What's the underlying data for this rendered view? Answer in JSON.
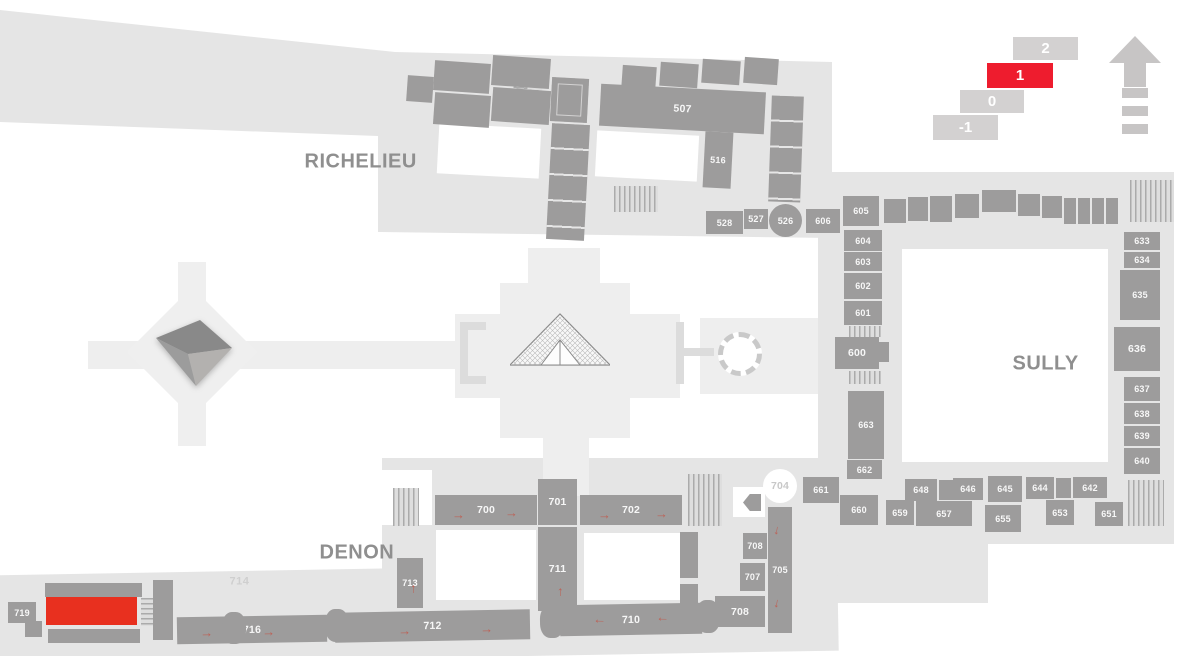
{
  "colors": {
    "building": "#e5e5e5",
    "plaza": "#eeeeee",
    "room": "#9d9c9c",
    "room_text": "#ffffff",
    "selected_room": "#e8301f",
    "floor_active": "#ee1c2e",
    "floor_inactive": "#d3d1d1",
    "wing_label": "#8f8f8f",
    "arrow": "#c2584b"
  },
  "glyphs": {
    "arrow": "→"
  },
  "floor_selector": {
    "floors": [
      {
        "label": "2",
        "x": 1013,
        "y": 37,
        "w": 65,
        "h": 23,
        "active": false
      },
      {
        "label": "1",
        "x": 987,
        "y": 63,
        "w": 66,
        "h": 25,
        "active": true
      },
      {
        "label": "0",
        "x": 960,
        "y": 90,
        "w": 64,
        "h": 23,
        "active": false
      },
      {
        "label": "-1",
        "x": 933,
        "y": 115,
        "w": 65,
        "h": 25,
        "active": false
      }
    ]
  },
  "wing_labels": [
    {
      "text": "RICHELIEU",
      "x": 305,
      "y": 151,
      "small": false
    },
    {
      "text": "SULLY",
      "x": 1013,
      "y": 353,
      "small": false
    },
    {
      "text": "DENON",
      "x": 320,
      "y": 542,
      "small": false
    },
    {
      "text": "714",
      "x": 230,
      "y": 576,
      "small": true
    }
  ],
  "map": {
    "base_shapes": [
      {
        "x": 0,
        "y": 0,
        "w": 1186,
        "h": 300,
        "rot": 0,
        "color": "#e5e5e5",
        "clip": "polygon(0px 10px,395px 52px,832px 62px,832px 238px,378px 232px,378px 136px,0px 122px)"
      },
      {
        "x": 818,
        "y": 172,
        "w": 356,
        "h": 372,
        "rot": 0,
        "color": "#e5e5e5",
        "clip": ""
      },
      {
        "x": 382,
        "y": 458,
        "w": 606,
        "h": 145,
        "rot": 0,
        "color": "#e5e5e5",
        "clip": ""
      },
      {
        "x": -12,
        "y": 568,
        "w": 850,
        "h": 90,
        "rot": -1,
        "color": "#e5e5e5",
        "clip": ""
      },
      {
        "x": 500,
        "y": 283,
        "w": 130,
        "h": 155,
        "rot": 0,
        "color": "#eeeeee",
        "clip": ""
      },
      {
        "x": 455,
        "y": 314,
        "w": 225,
        "h": 84,
        "rot": 0,
        "color": "#eeeeee",
        "clip": ""
      },
      {
        "x": 528,
        "y": 248,
        "w": 72,
        "h": 42,
        "rot": 0,
        "color": "#eeeeee",
        "clip": ""
      },
      {
        "x": 543,
        "y": 432,
        "w": 46,
        "h": 64,
        "rot": 0,
        "color": "#eeeeee",
        "clip": ""
      },
      {
        "x": 88,
        "y": 341,
        "w": 375,
        "h": 28,
        "rot": 0,
        "color": "#eeeeee",
        "clip": ""
      },
      {
        "x": 146,
        "y": 306,
        "w": 92,
        "h": 92,
        "rot": 45,
        "color": "#efefef",
        "clip": ""
      },
      {
        "x": 178,
        "y": 262,
        "w": 28,
        "h": 46,
        "rot": 0,
        "color": "#efefef",
        "clip": ""
      },
      {
        "x": 178,
        "y": 398,
        "w": 28,
        "h": 48,
        "rot": 0,
        "color": "#efefef",
        "clip": ""
      },
      {
        "x": 700,
        "y": 318,
        "w": 118,
        "h": 76,
        "rot": 0,
        "color": "#eeeeee",
        "clip": ""
      },
      {
        "x": 460,
        "y": 322,
        "w": 8,
        "h": 62,
        "rot": 0,
        "color": "#dcdcdc",
        "clip": ""
      },
      {
        "x": 460,
        "y": 322,
        "w": 26,
        "h": 8,
        "rot": 0,
        "color": "#dcdcdc",
        "clip": ""
      },
      {
        "x": 460,
        "y": 376,
        "w": 26,
        "h": 8,
        "rot": 0,
        "color": "#dcdcdc",
        "clip": ""
      },
      {
        "x": 676,
        "y": 322,
        "w": 8,
        "h": 62,
        "rot": 0,
        "color": "#dcdcdc",
        "clip": ""
      },
      {
        "x": 684,
        "y": 348,
        "w": 30,
        "h": 8,
        "rot": 0,
        "color": "#dcdcdc",
        "clip": ""
      }
    ],
    "courtyards": [
      {
        "x": 438,
        "y": 126,
        "w": 102,
        "h": 50,
        "rot": 3
      },
      {
        "x": 596,
        "y": 133,
        "w": 102,
        "h": 46,
        "rot": 3
      },
      {
        "x": 902,
        "y": 249,
        "w": 206,
        "h": 213,
        "rot": 0
      },
      {
        "x": 436,
        "y": 530,
        "w": 100,
        "h": 70,
        "rot": 0
      },
      {
        "x": 584,
        "y": 533,
        "w": 96,
        "h": 67,
        "rot": 0
      },
      {
        "x": 380,
        "y": 470,
        "w": 52,
        "h": 55,
        "rot": 0
      },
      {
        "x": 733,
        "y": 487,
        "w": 32,
        "h": 30,
        "rot": 0
      }
    ],
    "roundabout": {
      "x": 718,
      "y": 332,
      "w": 44,
      "h": 44
    },
    "stairs": [
      {
        "x": 513,
        "y": 72,
        "w": 14,
        "h": 46,
        "rot": 4,
        "dir": "h"
      },
      {
        "x": 528,
        "y": 70,
        "w": 14,
        "h": 46,
        "rot": 4,
        "dir": "h"
      },
      {
        "x": 614,
        "y": 186,
        "w": 44,
        "h": 26,
        "rot": 0,
        "dir": "v"
      },
      {
        "x": 849,
        "y": 326,
        "w": 32,
        "h": 11,
        "rot": 0,
        "dir": "v"
      },
      {
        "x": 849,
        "y": 371,
        "w": 32,
        "h": 13,
        "rot": 0,
        "dir": "v"
      },
      {
        "x": 1130,
        "y": 180,
        "w": 44,
        "h": 42,
        "rot": 0,
        "dir": "v"
      },
      {
        "x": 1128,
        "y": 480,
        "w": 36,
        "h": 46,
        "rot": 0,
        "dir": "v"
      },
      {
        "x": 393,
        "y": 488,
        "w": 26,
        "h": 38,
        "rot": 0,
        "dir": "v"
      },
      {
        "x": 688,
        "y": 474,
        "w": 34,
        "h": 52,
        "rot": 0,
        "dir": "v"
      },
      {
        "x": 141,
        "y": 598,
        "w": 14,
        "h": 28,
        "rot": 0,
        "dir": "h"
      }
    ],
    "rooms": [
      {
        "label": "",
        "x": 407,
        "y": 76,
        "w": 26,
        "h": 26,
        "rot": 4,
        "variant": ""
      },
      {
        "label": "",
        "x": 434,
        "y": 62,
        "w": 56,
        "h": 30,
        "rot": 4,
        "variant": ""
      },
      {
        "label": "",
        "x": 492,
        "y": 57,
        "w": 58,
        "h": 30,
        "rot": 4,
        "variant": ""
      },
      {
        "label": "",
        "x": 434,
        "y": 94,
        "w": 56,
        "h": 32,
        "rot": 4,
        "variant": ""
      },
      {
        "label": "",
        "x": 492,
        "y": 89,
        "w": 58,
        "h": 34,
        "rot": 4,
        "variant": ""
      },
      {
        "label": "",
        "x": 551,
        "y": 78,
        "w": 37,
        "h": 44,
        "rot": 3,
        "variant": "corners"
      },
      {
        "label": "",
        "x": 549,
        "y": 124,
        "w": 38,
        "h": 116,
        "rot": 3,
        "variant": "dividers"
      },
      {
        "label": "",
        "x": 622,
        "y": 66,
        "w": 34,
        "h": 24,
        "rot": 4,
        "variant": ""
      },
      {
        "label": "",
        "x": 660,
        "y": 63,
        "w": 38,
        "h": 24,
        "rot": 4,
        "variant": ""
      },
      {
        "label": "",
        "x": 702,
        "y": 60,
        "w": 38,
        "h": 24,
        "rot": 4,
        "variant": ""
      },
      {
        "label": "",
        "x": 744,
        "y": 58,
        "w": 34,
        "h": 26,
        "rot": 4,
        "variant": ""
      },
      {
        "label": "507",
        "x": 600,
        "y": 88,
        "w": 165,
        "h": 42,
        "rot": 3,
        "variant": "big"
      },
      {
        "label": "516",
        "x": 704,
        "y": 132,
        "w": 28,
        "h": 56,
        "rot": 3,
        "variant": ""
      },
      {
        "label": "",
        "x": 770,
        "y": 96,
        "w": 32,
        "h": 106,
        "rot": 2,
        "variant": "dividers"
      },
      {
        "label": "528",
        "x": 706,
        "y": 211,
        "w": 37,
        "h": 23,
        "rot": 0,
        "variant": ""
      },
      {
        "label": "527",
        "x": 744,
        "y": 209,
        "w": 24,
        "h": 20,
        "rot": 0,
        "variant": ""
      },
      {
        "label": "526",
        "x": 769,
        "y": 204,
        "w": 33,
        "h": 33,
        "rot": 0,
        "variant": "circle"
      },
      {
        "label": "606",
        "x": 806,
        "y": 209,
        "w": 34,
        "h": 24,
        "rot": 0,
        "variant": ""
      },
      {
        "label": "605",
        "x": 843,
        "y": 196,
        "w": 36,
        "h": 30,
        "rot": 0,
        "variant": ""
      },
      {
        "label": "",
        "x": 884,
        "y": 199,
        "w": 22,
        "h": 24,
        "rot": 0,
        "variant": ""
      },
      {
        "label": "",
        "x": 908,
        "y": 197,
        "w": 20,
        "h": 24,
        "rot": 0,
        "variant": ""
      },
      {
        "label": "",
        "x": 930,
        "y": 196,
        "w": 22,
        "h": 26,
        "rot": 0,
        "variant": ""
      },
      {
        "label": "",
        "x": 955,
        "y": 194,
        "w": 24,
        "h": 24,
        "rot": 0,
        "variant": ""
      },
      {
        "label": "",
        "x": 982,
        "y": 190,
        "w": 34,
        "h": 22,
        "rot": 0,
        "variant": ""
      },
      {
        "label": "",
        "x": 1018,
        "y": 194,
        "w": 22,
        "h": 22,
        "rot": 0,
        "variant": ""
      },
      {
        "label": "",
        "x": 1042,
        "y": 196,
        "w": 20,
        "h": 22,
        "rot": 0,
        "variant": ""
      },
      {
        "label": "",
        "x": 1064,
        "y": 198,
        "w": 56,
        "h": 26,
        "rot": 0,
        "variant": "vdividers"
      },
      {
        "label": "604",
        "x": 844,
        "y": 230,
        "w": 38,
        "h": 21,
        "rot": 0,
        "variant": ""
      },
      {
        "label": "603",
        "x": 844,
        "y": 252,
        "w": 38,
        "h": 19,
        "rot": 0,
        "variant": ""
      },
      {
        "label": "602",
        "x": 844,
        "y": 273,
        "w": 38,
        "h": 26,
        "rot": 0,
        "variant": ""
      },
      {
        "label": "601",
        "x": 844,
        "y": 301,
        "w": 38,
        "h": 24,
        "rot": 0,
        "variant": ""
      },
      {
        "label": "600",
        "x": 835,
        "y": 337,
        "w": 44,
        "h": 32,
        "rot": 0,
        "variant": "big"
      },
      {
        "label": "",
        "x": 877,
        "y": 342,
        "w": 12,
        "h": 20,
        "rot": 0,
        "variant": ""
      },
      {
        "label": "663",
        "x": 848,
        "y": 391,
        "w": 36,
        "h": 68,
        "rot": 0,
        "variant": ""
      },
      {
        "label": "662",
        "x": 847,
        "y": 460,
        "w": 35,
        "h": 19,
        "rot": 0,
        "variant": ""
      },
      {
        "label": "661",
        "x": 803,
        "y": 477,
        "w": 36,
        "h": 26,
        "rot": 0,
        "variant": ""
      },
      {
        "label": "660",
        "x": 840,
        "y": 495,
        "w": 38,
        "h": 30,
        "rot": 0,
        "variant": ""
      },
      {
        "label": "648",
        "x": 905,
        "y": 479,
        "w": 32,
        "h": 22,
        "rot": 0,
        "variant": ""
      },
      {
        "label": "",
        "x": 939,
        "y": 480,
        "w": 14,
        "h": 20,
        "rot": 0,
        "variant": ""
      },
      {
        "label": "646",
        "x": 953,
        "y": 478,
        "w": 30,
        "h": 22,
        "rot": 0,
        "variant": ""
      },
      {
        "label": "645",
        "x": 988,
        "y": 476,
        "w": 34,
        "h": 26,
        "rot": 0,
        "variant": ""
      },
      {
        "label": "644",
        "x": 1026,
        "y": 477,
        "w": 28,
        "h": 22,
        "rot": 0,
        "variant": ""
      },
      {
        "label": "",
        "x": 1056,
        "y": 478,
        "w": 15,
        "h": 20,
        "rot": 0,
        "variant": ""
      },
      {
        "label": "642",
        "x": 1073,
        "y": 477,
        "w": 34,
        "h": 21,
        "rot": 0,
        "variant": ""
      },
      {
        "label": "659",
        "x": 886,
        "y": 500,
        "w": 28,
        "h": 25,
        "rot": 0,
        "variant": ""
      },
      {
        "label": "657",
        "x": 916,
        "y": 501,
        "w": 56,
        "h": 25,
        "rot": 0,
        "variant": ""
      },
      {
        "label": "655",
        "x": 985,
        "y": 505,
        "w": 36,
        "h": 27,
        "rot": 0,
        "variant": ""
      },
      {
        "label": "653",
        "x": 1046,
        "y": 500,
        "w": 28,
        "h": 25,
        "rot": 0,
        "variant": ""
      },
      {
        "label": "651",
        "x": 1095,
        "y": 502,
        "w": 28,
        "h": 24,
        "rot": 0,
        "variant": ""
      },
      {
        "label": "633",
        "x": 1124,
        "y": 232,
        "w": 36,
        "h": 18,
        "rot": 0,
        "variant": ""
      },
      {
        "label": "634",
        "x": 1124,
        "y": 252,
        "w": 36,
        "h": 16,
        "rot": 0,
        "variant": ""
      },
      {
        "label": "635",
        "x": 1120,
        "y": 270,
        "w": 40,
        "h": 50,
        "rot": 0,
        "variant": ""
      },
      {
        "label": "636",
        "x": 1114,
        "y": 327,
        "w": 46,
        "h": 44,
        "rot": 0,
        "variant": "big"
      },
      {
        "label": "637",
        "x": 1124,
        "y": 377,
        "w": 36,
        "h": 24,
        "rot": 0,
        "variant": ""
      },
      {
        "label": "638",
        "x": 1124,
        "y": 403,
        "w": 36,
        "h": 21,
        "rot": 0,
        "variant": ""
      },
      {
        "label": "639",
        "x": 1124,
        "y": 426,
        "w": 36,
        "h": 20,
        "rot": 0,
        "variant": ""
      },
      {
        "label": "640",
        "x": 1124,
        "y": 448,
        "w": 36,
        "h": 26,
        "rot": 0,
        "variant": ""
      },
      {
        "label": "700",
        "x": 435,
        "y": 495,
        "w": 102,
        "h": 30,
        "rot": 0,
        "variant": "big"
      },
      {
        "label": "701",
        "x": 538,
        "y": 479,
        "w": 39,
        "h": 46,
        "rot": 0,
        "variant": "big"
      },
      {
        "label": "702",
        "x": 580,
        "y": 495,
        "w": 102,
        "h": 30,
        "rot": 0,
        "variant": "big"
      },
      {
        "label": "711",
        "x": 538,
        "y": 527,
        "w": 39,
        "h": 84,
        "rot": 0,
        "variant": "big"
      },
      {
        "label": "713",
        "x": 397,
        "y": 558,
        "w": 26,
        "h": 50,
        "rot": 0,
        "variant": ""
      },
      {
        "label": "",
        "x": 680,
        "y": 532,
        "w": 18,
        "h": 46,
        "rot": 0,
        "variant": ""
      },
      {
        "label": "",
        "x": 680,
        "y": 584,
        "w": 18,
        "h": 44,
        "rot": 0,
        "variant": ""
      },
      {
        "label": "704",
        "x": 763,
        "y": 469,
        "w": 34,
        "h": 34,
        "rot": 0,
        "variant": "light-circle"
      },
      {
        "label": "",
        "x": 743,
        "y": 494,
        "w": 18,
        "h": 17,
        "rot": 0,
        "variant": "pointer"
      },
      {
        "label": "705",
        "x": 768,
        "y": 507,
        "w": 24,
        "h": 126,
        "rot": 0,
        "variant": ""
      },
      {
        "label": "708",
        "x": 743,
        "y": 533,
        "w": 24,
        "h": 26,
        "rot": 0,
        "variant": ""
      },
      {
        "label": "707",
        "x": 740,
        "y": 563,
        "w": 25,
        "h": 28,
        "rot": 0,
        "variant": ""
      },
      {
        "label": "708",
        "x": 715,
        "y": 596,
        "w": 50,
        "h": 31,
        "rot": 0,
        "variant": "big"
      },
      {
        "label": "716",
        "x": 177,
        "y": 616,
        "w": 150,
        "h": 27,
        "rot": -1,
        "variant": "big"
      },
      {
        "label": "712",
        "x": 335,
        "y": 611,
        "w": 195,
        "h": 30,
        "rot": -1,
        "variant": "big"
      },
      {
        "label": "710",
        "x": 560,
        "y": 604,
        "w": 142,
        "h": 31,
        "rot": -1,
        "variant": "big"
      },
      {
        "label": "",
        "x": 222,
        "y": 612,
        "w": 24,
        "h": 32,
        "rot": -1,
        "variant": "bulge"
      },
      {
        "label": "",
        "x": 325,
        "y": 609,
        "w": 24,
        "h": 33,
        "rot": -1,
        "variant": "bulge"
      },
      {
        "label": "",
        "x": 540,
        "y": 605,
        "w": 24,
        "h": 33,
        "rot": -1,
        "variant": "bulge"
      },
      {
        "label": "",
        "x": 696,
        "y": 600,
        "w": 24,
        "h": 33,
        "rot": -1,
        "variant": "bulge"
      },
      {
        "label": "719",
        "x": 8,
        "y": 602,
        "w": 28,
        "h": 21,
        "rot": 0,
        "variant": ""
      },
      {
        "label": "",
        "x": 45,
        "y": 583,
        "w": 97,
        "h": 14,
        "rot": 0,
        "variant": ""
      },
      {
        "label": "",
        "x": 46,
        "y": 597,
        "w": 91,
        "h": 28,
        "rot": 0,
        "variant": "selected"
      },
      {
        "label": "",
        "x": 48,
        "y": 629,
        "w": 92,
        "h": 14,
        "rot": 0,
        "variant": ""
      },
      {
        "label": "",
        "x": 153,
        "y": 580,
        "w": 20,
        "h": 60,
        "rot": 0,
        "variant": ""
      },
      {
        "label": "",
        "x": 25,
        "y": 621,
        "w": 17,
        "h": 16,
        "rot": 0,
        "variant": ""
      }
    ],
    "arrows": [
      {
        "x": 452,
        "y": 508,
        "r": 0
      },
      {
        "x": 505,
        "y": 506,
        "r": 0
      },
      {
        "x": 598,
        "y": 508,
        "r": 0
      },
      {
        "x": 655,
        "y": 507,
        "r": 0
      },
      {
        "x": 551,
        "y": 585,
        "r": -90
      },
      {
        "x": 404,
        "y": 582,
        "r": -90
      },
      {
        "x": 200,
        "y": 626,
        "r": -1
      },
      {
        "x": 262,
        "y": 625,
        "r": -1
      },
      {
        "x": 398,
        "y": 624,
        "r": -1
      },
      {
        "x": 480,
        "y": 622,
        "r": -1
      },
      {
        "x": 592,
        "y": 617,
        "r": 181
      },
      {
        "x": 655,
        "y": 615,
        "r": 181
      },
      {
        "x": 772,
        "y": 525,
        "r": 100
      },
      {
        "x": 772,
        "y": 598,
        "r": 100
      }
    ]
  }
}
